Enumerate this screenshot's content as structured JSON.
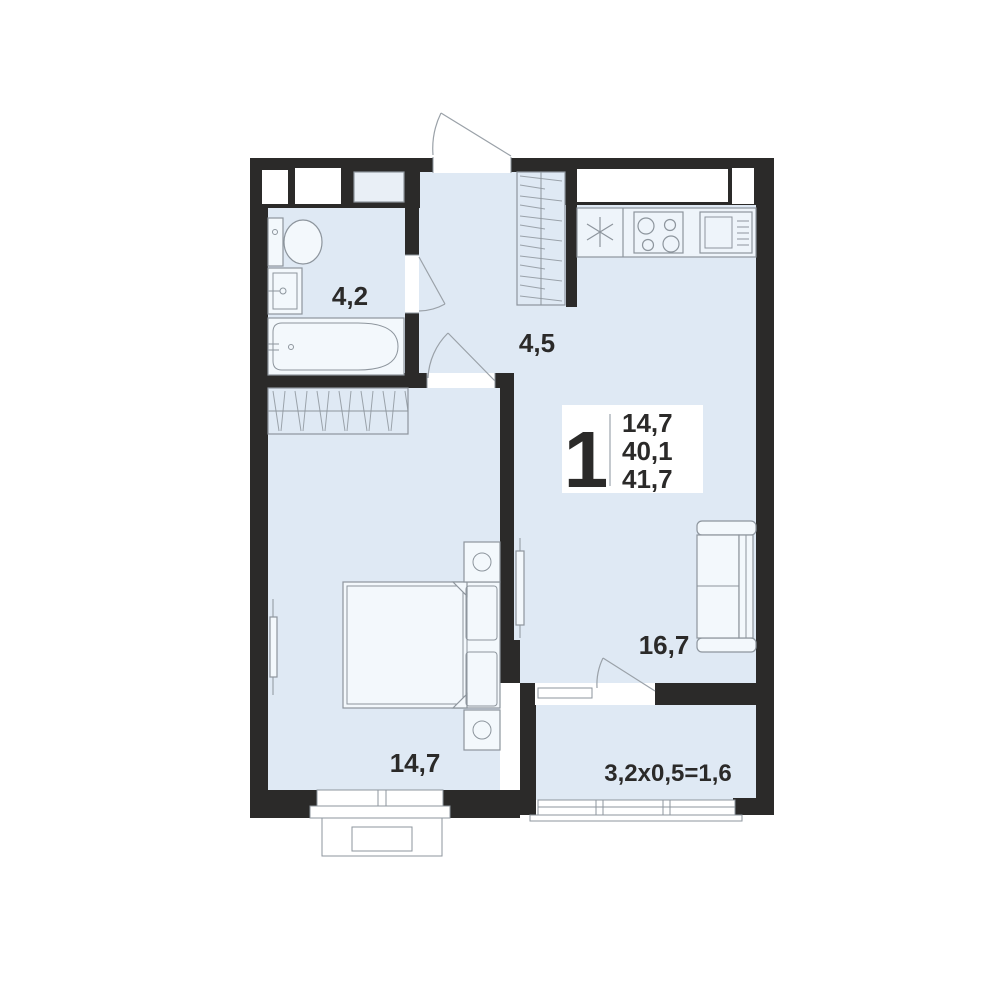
{
  "title": "1-room apartment floor plan",
  "unit_info": {
    "rooms_count": "1",
    "living_area": "14,7",
    "total_area": "40,1",
    "total_area_with_balcony": "41,7"
  },
  "room_labels": {
    "bathroom": "4,2",
    "hallway": "4,5",
    "kitchen_living": "16,7",
    "bedroom": "14,7",
    "balcony": "3,2x0,5=1,6"
  },
  "colors": {
    "wall": "#2b2a29",
    "floor": "#dfe9f4",
    "furniture_fill": "#eef4fa",
    "outline": "#8d959d",
    "text": "#2b2a29",
    "background": "#ffffff"
  }
}
